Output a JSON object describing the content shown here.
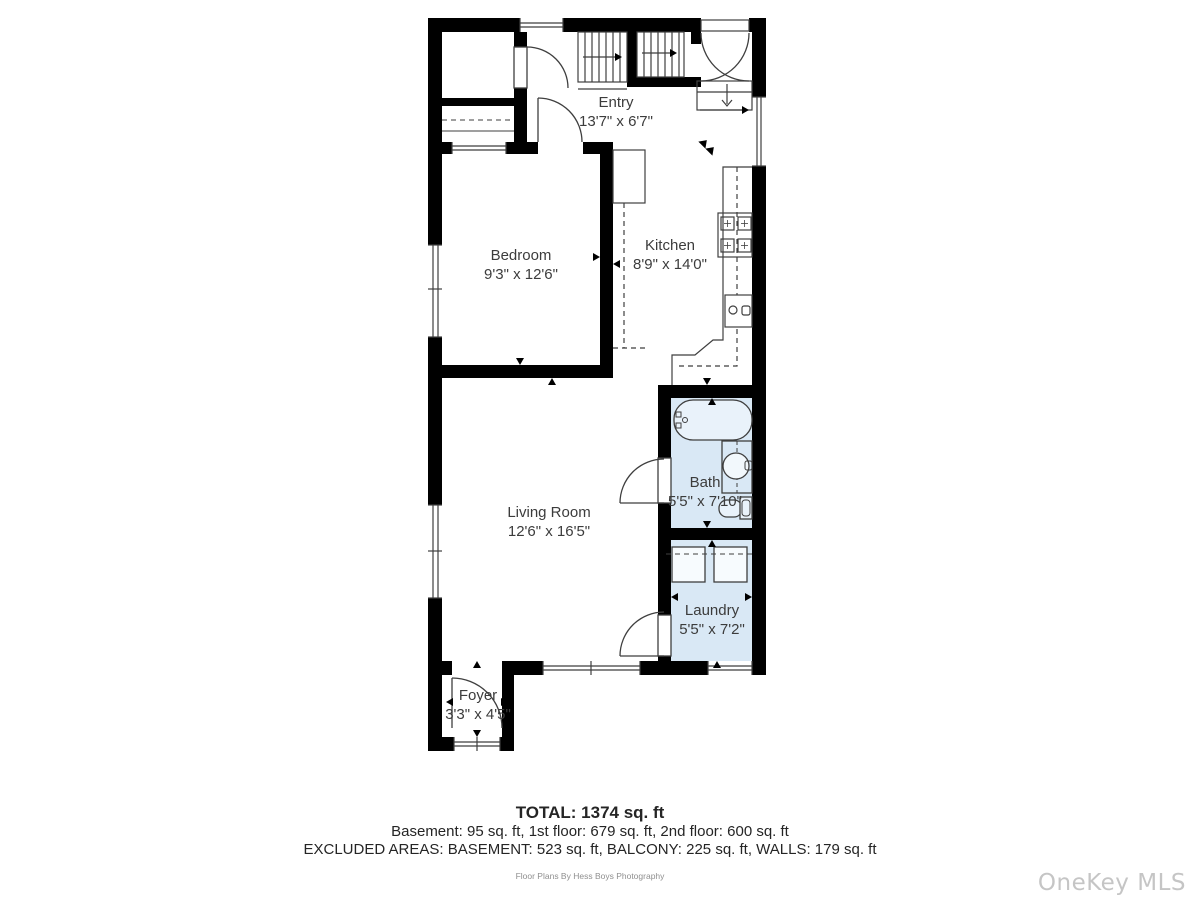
{
  "rooms": [
    {
      "name": "Entry",
      "dims": "13'7\" x 6'7\""
    },
    {
      "name": "Bedroom",
      "dims": "9'3\" x 12'6\""
    },
    {
      "name": "Kitchen",
      "dims": "8'9\" x 14'0\""
    },
    {
      "name": "Bath",
      "dims": "5'5\" x 7'10\""
    },
    {
      "name": "Living Room",
      "dims": "12'6\" x 16'5\""
    },
    {
      "name": "Laundry",
      "dims": "5'5\" x 7'2\""
    },
    {
      "name": "Foyer",
      "dims": "3'3\" x 4'5\""
    }
  ],
  "summary": {
    "total": "TOTAL: 1374 sq. ft",
    "floors": "Basement: 95 sq. ft, 1st floor: 679 sq. ft, 2nd floor: 600 sq. ft",
    "excluded": "EXCLUDED AREAS: BASEMENT: 523 sq. ft, BALCONY: 225 sq. ft, WALLS: 179 sq. ft"
  },
  "credit": "Floor Plans By Hess Boys Photography",
  "watermark": "OneKey MLS",
  "colors": {
    "wall": "#000000",
    "line": "#3f3f3f",
    "wet_room_floor": "#d9e8f5",
    "label_text": "#3c3c3c",
    "credit_text": "#8f8f8f",
    "watermark_text": "#c5c5c5"
  }
}
